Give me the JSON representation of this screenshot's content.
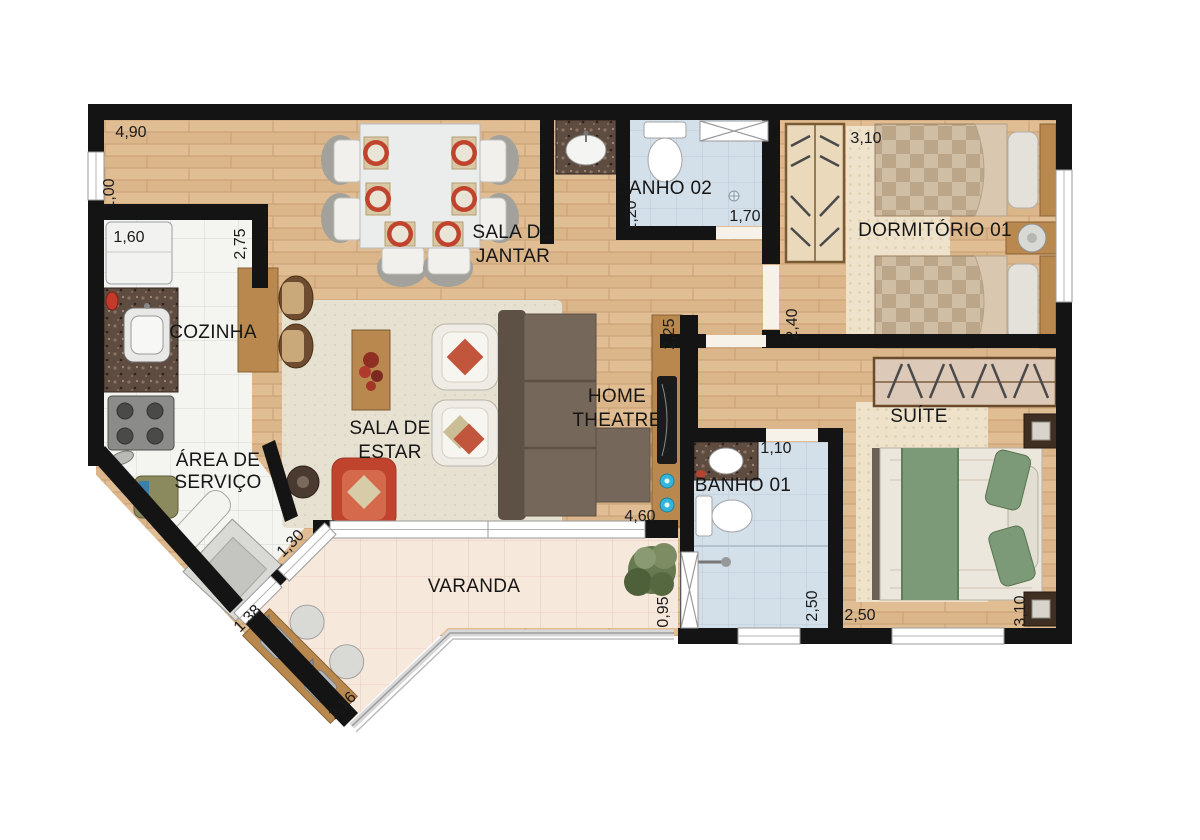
{
  "plan": {
    "rooms": {
      "cozinha": {
        "label": "COZINHA"
      },
      "sala_jantar": {
        "line1": "SALA DE",
        "line2": "JANTAR"
      },
      "banho02": {
        "label": "BANHO 02"
      },
      "dormitorio01": {
        "label": "DORMITÓRIO 01"
      },
      "sala_estar": {
        "line1": "SALA DE",
        "line2": "ESTAR"
      },
      "home_theatre": {
        "line1": "HOME",
        "line2": "THEATRE"
      },
      "suite": {
        "label": "SUÍTE"
      },
      "area_servico": {
        "line1": "ÁREA DE",
        "line2": "SERVIÇO"
      },
      "banho01": {
        "label": "BANHO 01"
      },
      "varanda": {
        "label": "VARANDA"
      }
    },
    "dimensions": {
      "jantar_top_width": "4,90",
      "jantar_left_depth": "1,00",
      "cozinha_width": "1,60",
      "cozinha_depth": "2,75",
      "banho02_width": "1,20",
      "banho02_length": "1,70",
      "dormitorio_width": "3,10",
      "dormitorio_depth": "2,40",
      "home_theatre_depth": "2,25",
      "estar_width": "4,60",
      "banho01_width": "1,10",
      "banho01_depth": "2,50",
      "varanda_door": "1,30",
      "servico_door": "1,38",
      "varanda_right_depth": "0,95",
      "varanda_wall": "2,16",
      "suite_width": "2,50",
      "suite_depth": "3,10"
    },
    "colors": {
      "wall": "#141414",
      "wood_floor": "#dfbc92",
      "white_tile": "#f4f4f1",
      "bath_tile": "#d3dfe9",
      "varanda_tile": "#f7e8dc",
      "wood_furniture": "#b9884e",
      "sofa_brown": "#75675a",
      "accent_red": "#c0432e",
      "bed_green": "#7c9a77"
    }
  }
}
